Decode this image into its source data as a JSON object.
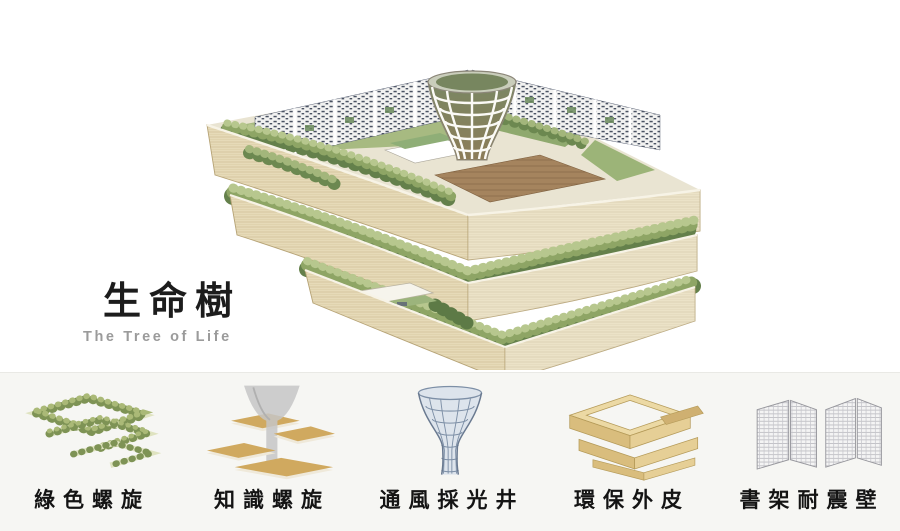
{
  "hero": {
    "title": "生命樹",
    "subtitle": "The Tree of Life",
    "illustration": "tree-of-life-building-axonometric-rendering",
    "illustration_elements": [
      "layered-curved-wood-bands",
      "roof-garden-trees",
      "ventilation-funnel-lattice-tower",
      "perforated-bookshelf-walls",
      "wood-deck-terrace"
    ]
  },
  "features": {
    "items": [
      {
        "label": "綠色螺旋",
        "icon": "green-spiral-icon"
      },
      {
        "label": "知識螺旋",
        "icon": "knowledge-spiral-icon"
      },
      {
        "label": "通風採光井",
        "icon": "light-well-funnel-icon"
      },
      {
        "label": "環保外皮",
        "icon": "eco-skin-icon"
      },
      {
        "label": "書架耐震壁",
        "icon": "bookshelf-wall-icon"
      }
    ]
  },
  "colors": {
    "background": "#ffffff",
    "footer_background": "#f6f6f3",
    "title": "#1c1c1c",
    "subtitle": "#9b9b9b",
    "label": "#141414",
    "wood": "#e6dab8",
    "wood_edge": "#b3a074",
    "foliage_light": "#b7c78e",
    "foliage_mid": "#8ea565",
    "foliage_dark": "#64804b",
    "green_roof": "#a7ba81",
    "deck": "#a5845e",
    "wall_speckle": "#4a5262",
    "funnel_lattice": "#7d8fa6",
    "plate_tan": "#d0a95f"
  }
}
